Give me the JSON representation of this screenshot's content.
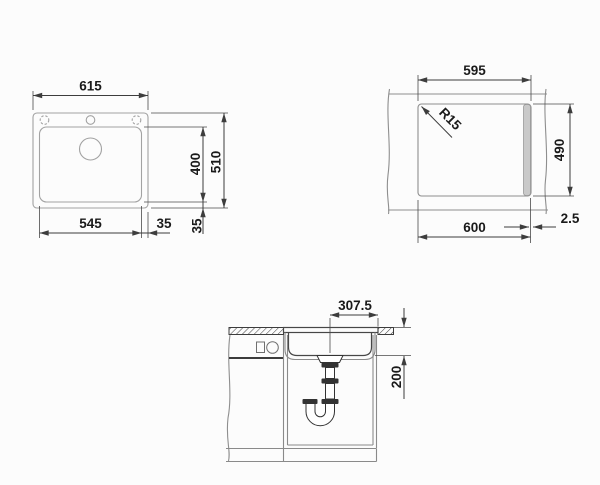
{
  "drawing_type": "sink-installation-technical-drawing",
  "colors": {
    "background": "#fcfcfc",
    "outline_light": "#a2a2a2",
    "outline_mid": "#8e8e8e",
    "dimension_line": "#3d3d3d",
    "text": "#1a1a1a",
    "cutout_edge_shade": "#c9c9c9"
  },
  "plan_view": {
    "labels": {
      "overall_width": "615",
      "overall_depth": "510",
      "bowl_depth": "400",
      "bowl_width": "545",
      "right_margin": "35",
      "bottom_margin": "35"
    }
  },
  "cutout_view": {
    "labels": {
      "cutout_width": "595",
      "cutout_depth": "490",
      "corner_radius": "R15",
      "outer_width": "600",
      "edge_offset": "2.5"
    }
  },
  "section_view": {
    "labels": {
      "drain_offset": "307.5",
      "bowl_inner_depth": "200"
    }
  }
}
